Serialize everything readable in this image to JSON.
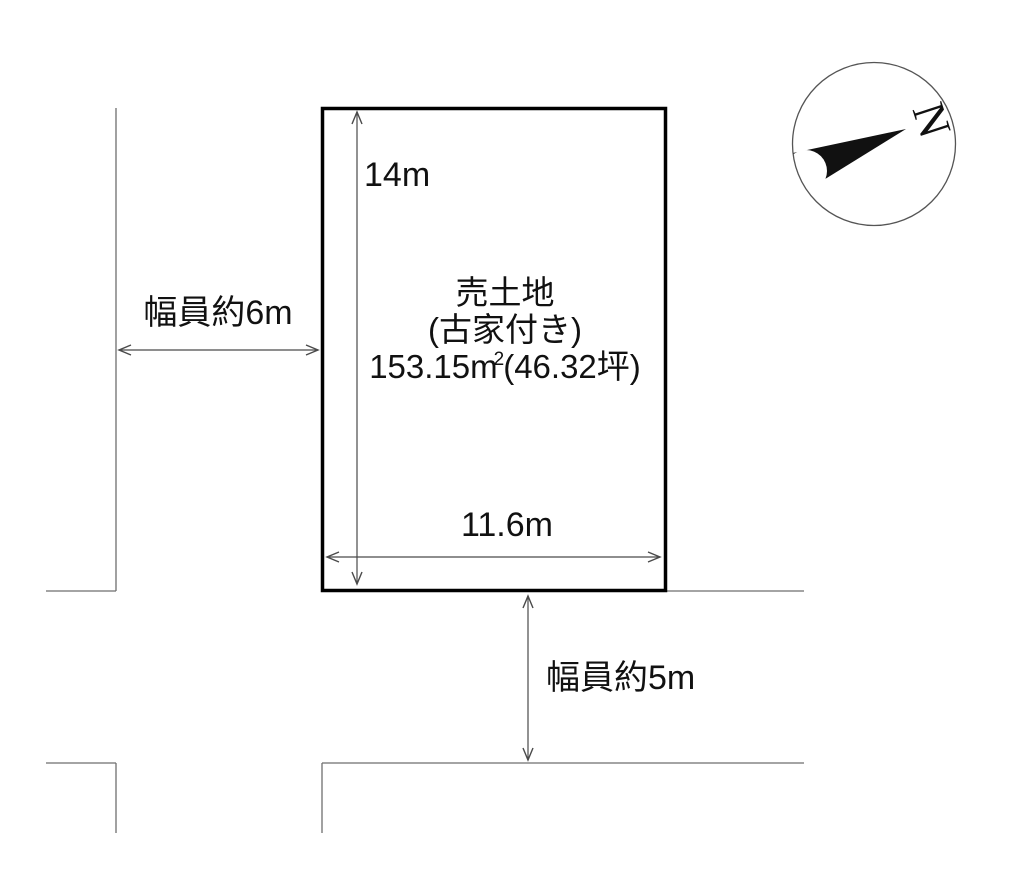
{
  "diagram": {
    "plot": {
      "title": "売土地",
      "subtitle": "(古家付き)",
      "area_prefix": "153.15m",
      "area_sup": "2",
      "area_suffix": "(46.32坪)"
    },
    "dimensions": {
      "height_label": "14m",
      "width_label": "11.6m"
    },
    "roads": {
      "left_label": "幅員約6m",
      "bottom_label": "幅員約5m"
    },
    "compass": {
      "label": "N"
    }
  },
  "colors": {
    "background": "#ffffff",
    "plot_border": "#000000",
    "road_line": "#6e6e6e",
    "dimension_line": "#4a4a4a",
    "compass_outline": "#555555",
    "needle_fill": "#111111",
    "text": "#111111"
  }
}
